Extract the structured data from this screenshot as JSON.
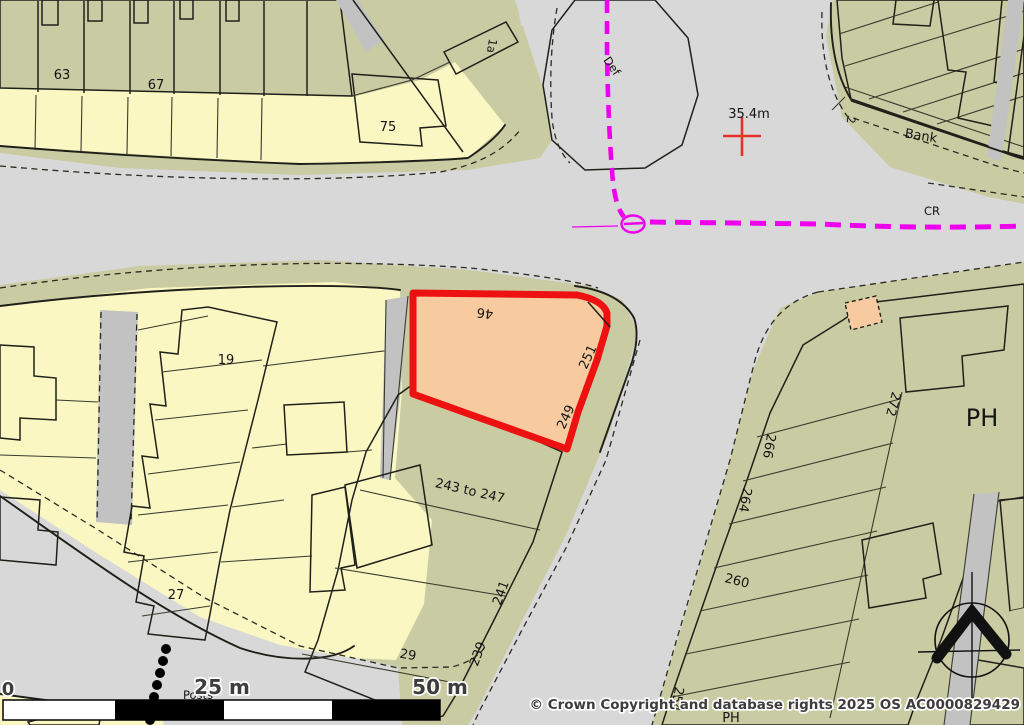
{
  "map": {
    "labels": {
      "n63": "63",
      "n67": "67",
      "n75": "75",
      "n1a": "1a",
      "def": "Def",
      "spot_height": "35.4m",
      "bank": "Bank",
      "n2": "2",
      "cr": "CR",
      "n46": "46",
      "n251": "251",
      "n249": "249",
      "n19": "19",
      "n27": "27",
      "n243": "243 to 247",
      "n241": "241",
      "n29": "29",
      "n239": "239",
      "posts": "Posts",
      "ph": "PH",
      "ph_small": "PH",
      "n272": "272",
      "n266": "266",
      "n264": "264",
      "n260": "260",
      "n254": "254"
    },
    "scale_bar": {
      "start": "0",
      "mid": "25 m",
      "end": "50 m"
    },
    "copyright": "© Crown Copyright and database rights 2025 OS AC0000829429",
    "colors": {
      "road": "#d8d8d8",
      "verge": "#c9cba2",
      "plot": "#faf7c3",
      "building": "#f7cb9f",
      "building_light": "#fdfad0",
      "green_space": "#a8e696",
      "boundary_magenta": "#ee00ee",
      "selected_parcel_outline": "#ee1111",
      "spot_height_red": "#e53228"
    }
  }
}
